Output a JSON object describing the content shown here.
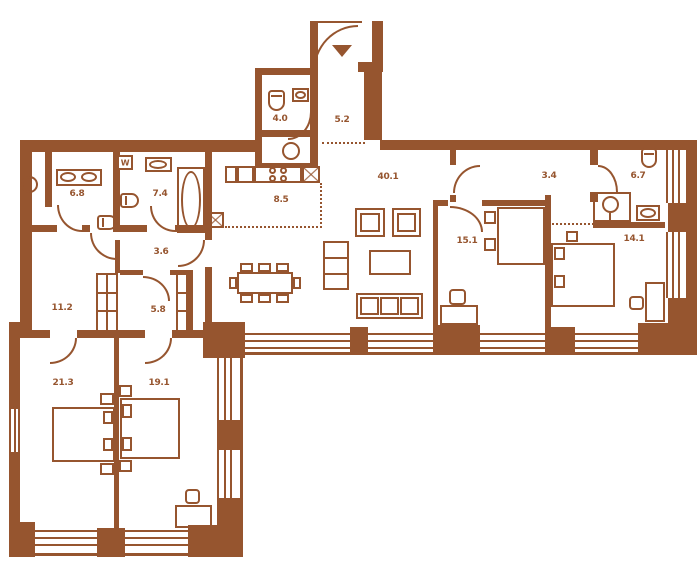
{
  "title": "apartment-floor-plan",
  "colors": {
    "line": "#96552F",
    "background": "#FFFFFF"
  },
  "rooms": [
    {
      "name": "wc",
      "area": "4.0"
    },
    {
      "name": "entry-hall",
      "area": "5.2"
    },
    {
      "name": "bathroom-1",
      "area": "6.8"
    },
    {
      "name": "bathroom-2",
      "area": "7.4"
    },
    {
      "name": "kitchen",
      "area": "8.5"
    },
    {
      "name": "living-room",
      "area": "40.1"
    },
    {
      "name": "inner-hall",
      "area": "3.4"
    },
    {
      "name": "bathroom-3",
      "area": "6.7"
    },
    {
      "name": "bedroom-1",
      "area": "15.1"
    },
    {
      "name": "bedroom-2",
      "area": "14.1"
    },
    {
      "name": "corridor",
      "area": "3.6"
    },
    {
      "name": "cabinet",
      "area": "11.2"
    },
    {
      "name": "wardrobe",
      "area": "5.8"
    },
    {
      "name": "bedroom-3",
      "area": "21.3"
    },
    {
      "name": "bedroom-4",
      "area": "19.1"
    }
  ],
  "marks": {
    "washer": "W"
  }
}
